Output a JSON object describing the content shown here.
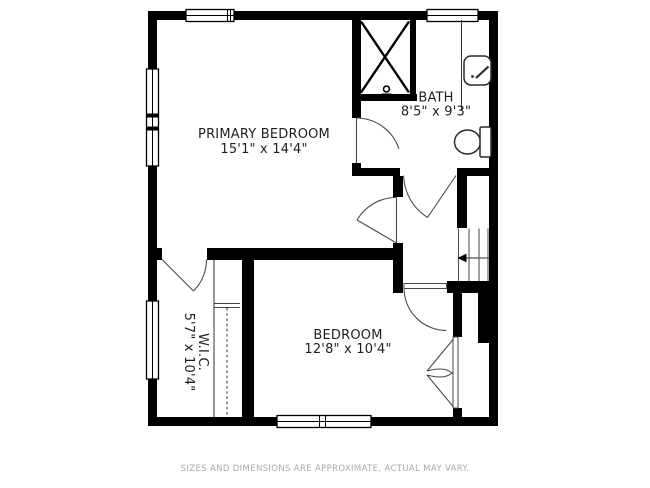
{
  "floor_plan": {
    "rooms": [
      {
        "id": "primary-bedroom",
        "name": "PRIMARY BEDROOM",
        "dimensions": "15'1\" x 14'4\""
      },
      {
        "id": "bath",
        "name": "BATH",
        "dimensions": "8'5\" x 9'3\""
      },
      {
        "id": "bedroom",
        "name": "BEDROOM",
        "dimensions": "12'8\" x 10'4\""
      },
      {
        "id": "wic",
        "name": "W.I.C.",
        "dimensions": "5'7\" x 10'4\""
      }
    ],
    "fixtures": [
      "shower",
      "vanity-sink",
      "toilet",
      "staircase",
      "closet-rod-and-shelf",
      "bifold-closet-doors"
    ],
    "window_count": 5,
    "disclaimer": "SIZES AND DIMENSIONS ARE APPROXIMATE, ACTUAL MAY VARY.",
    "colors": {
      "wall": "#000000",
      "background": "#ffffff",
      "line": "#4a4a4a",
      "label_text": "#1f1f1f",
      "disclaimer_text": "#a9a9a9"
    }
  }
}
